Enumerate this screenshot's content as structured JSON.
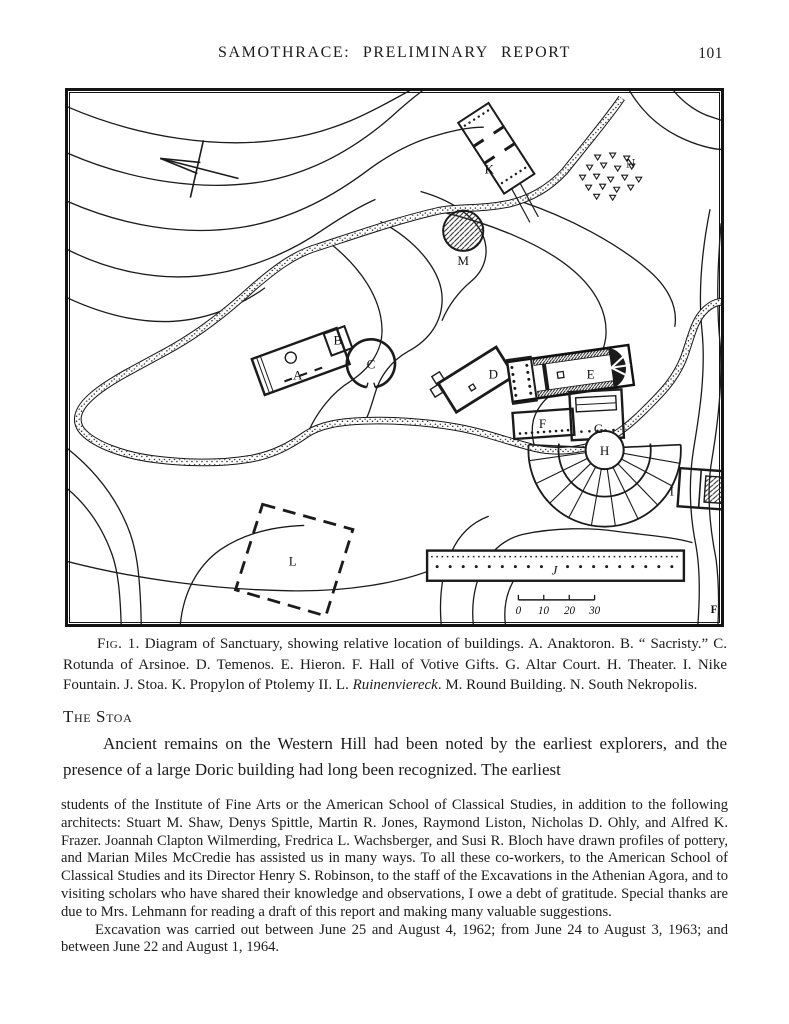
{
  "header": {
    "title": "SAMOTHRACE: PRELIMINARY REPORT",
    "page_number": "101"
  },
  "figure": {
    "caption": {
      "fig_label": "Fig. 1.",
      "text": "Diagram of Sanctuary, showing relative location of buildings. A. Anaktoron. B. “ Sacristy.” C. Rotunda of Arsinoe. D. Temenos. E. Hieron. F. Hall of Votive Gifts. G. Altar Court. H. Theater. I. Nike Fountain. J. Stoa. K. Propylon of Ptolemy II. L. ",
      "italic_term": "Ruinenviereck",
      "text_after": ". M. Round Building. N. South Nekropolis."
    },
    "map": {
      "labels": {
        "a": "A",
        "b": "B",
        "c": "C",
        "d": "D",
        "e": "E",
        "f": "F",
        "g": "G",
        "h": "H",
        "i": "I",
        "j": "J",
        "k": "K",
        "l": "L",
        "m": "M",
        "n": "N"
      },
      "scale_ticks": [
        "0",
        "10",
        "20",
        "30"
      ],
      "draftsman_initial": "F"
    },
    "ink_color": "#1b1b1b",
    "paper_color": "#ffffff"
  },
  "section": {
    "heading": "The Stoa",
    "paragraph": "Ancient remains on the Western Hill had been noted by the earliest explorers, and the presence of a large Doric building had long been recognized.  The earliest"
  },
  "footnote": {
    "para1": "students of the Institute of Fine Arts or the American School of Classical Studies, in addition to the following architects: Stuart M. Shaw, Denys Spittle, Martin R. Jones, Raymond Liston, Nicholas D. Ohly, and Alfred K. Frazer.  Joannah Clapton Wilmerding, Fredrica L. Wachsberger, and Susi R. Bloch have drawn profiles of pottery, and Marian Miles McCredie has assisted us in many ways.  To all these co-workers, to the American School of Classical Studies and its Director Henry S. Robinson, to the staff of the Excavations in the Athenian Agora, and to visiting scholars who have shared their knowledge and observations, I owe a debt of gratitude.  Special thanks are due to Mrs. Lehmann for reading a draft of this report and making many valuable suggestions.",
    "para2": "Excavation was carried out between June 25 and August 4, 1962; from June 24 to August 3, 1963; and between June 22 and August 1, 1964."
  }
}
